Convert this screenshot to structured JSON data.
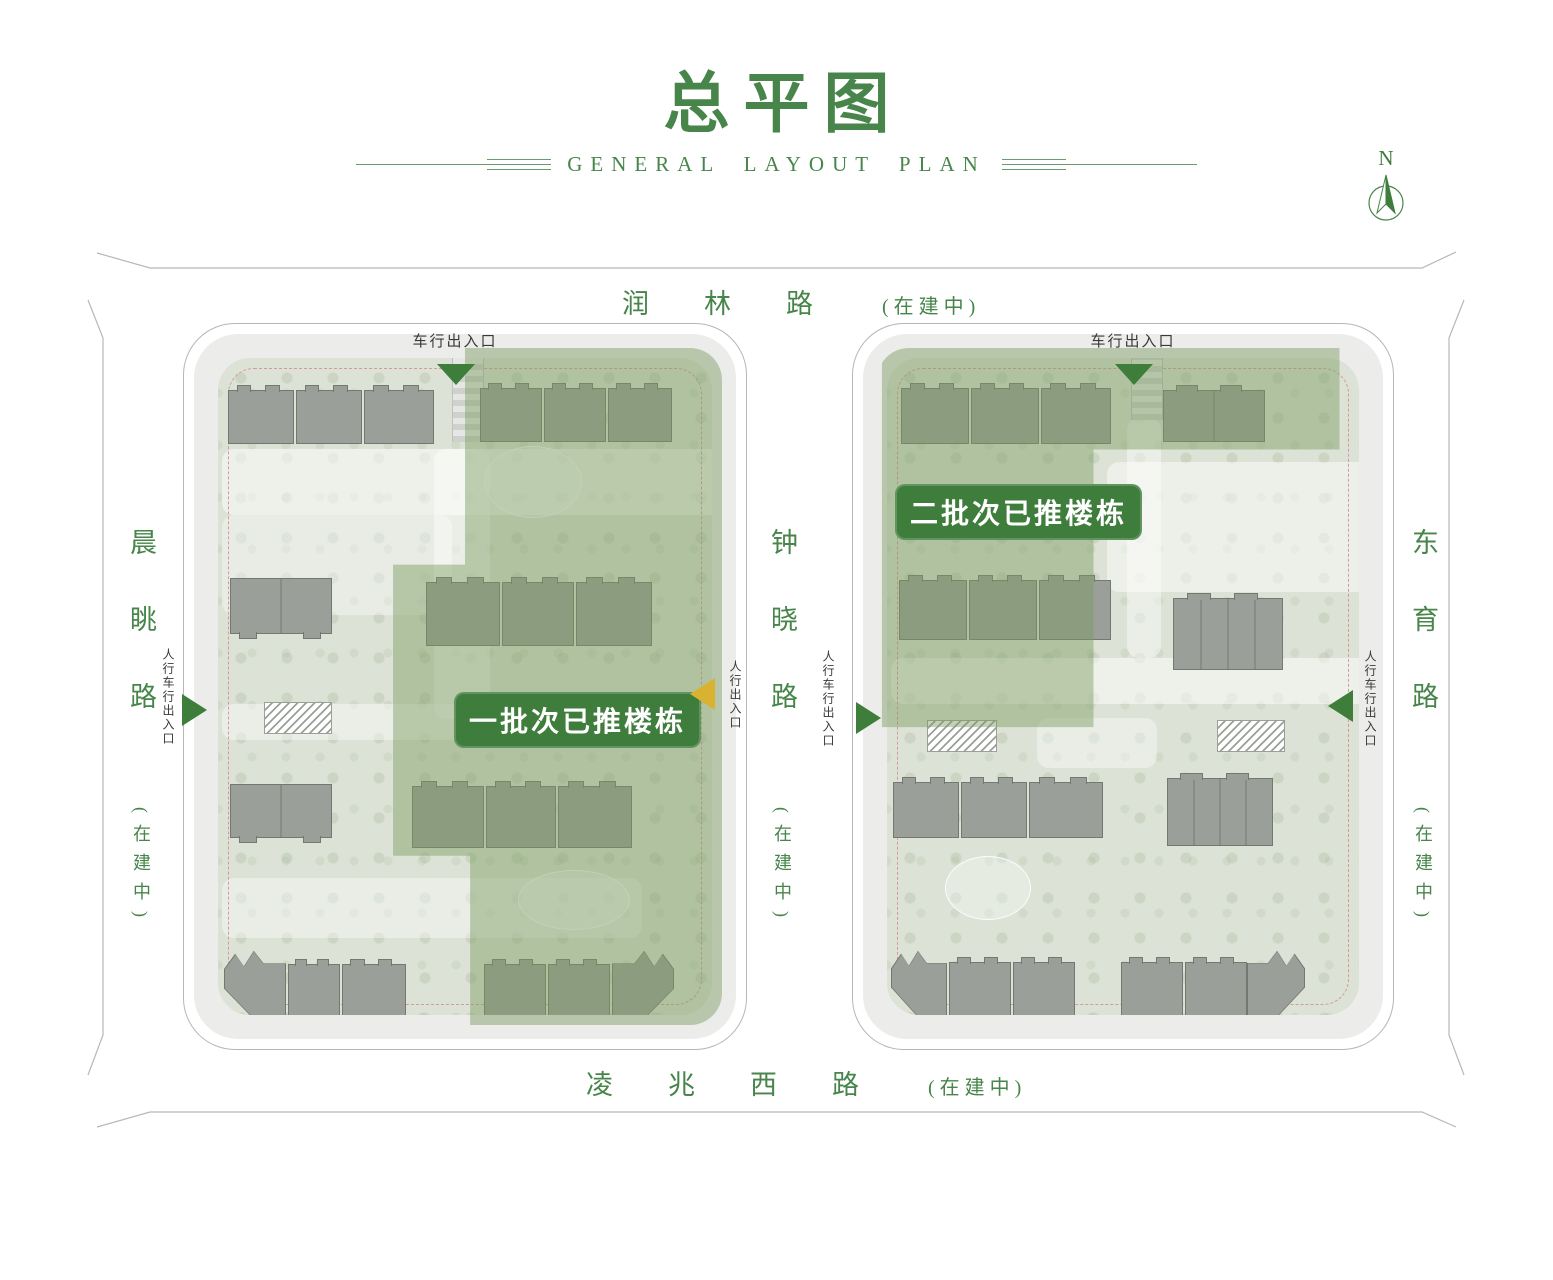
{
  "header": {
    "title": "总平图",
    "subtitle": "GENERAL LAYOUT PLAN"
  },
  "compass": {
    "north": "N"
  },
  "roads": {
    "top": {
      "name": "润林路",
      "status": "(在建中)"
    },
    "bottom": {
      "name": "凌兆西路",
      "status": "(在建中)"
    },
    "left": {
      "name": "晨眺路",
      "status": "(在建中)"
    },
    "middle": {
      "name": "钟晓路",
      "status": "(在建中)"
    },
    "right": {
      "name": "东育路",
      "status": "(在建中)"
    }
  },
  "badges": {
    "batch1": "一批次已推楼栋",
    "batch2": "二批次已推楼栋"
  },
  "entrances": {
    "vehicle": "车行出入口",
    "pedestrian": "人行出入口",
    "mixed": "人行车行出入口"
  },
  "icons": {
    "compass_arrow": "north-arrow-icon",
    "entrance_triangle_green": "green-arrow",
    "entrance_triangle_yellow": "yellow-arrow"
  },
  "colors": {
    "accent_green": "#47854a",
    "badge_green": "#3f7d3c",
    "overlay_green": "rgba(121,156,96,0.45)",
    "building_gray": "#9b9f9a",
    "entrance_yellow": "#d9b32f",
    "road_line_gray": "#b7b7b7"
  }
}
